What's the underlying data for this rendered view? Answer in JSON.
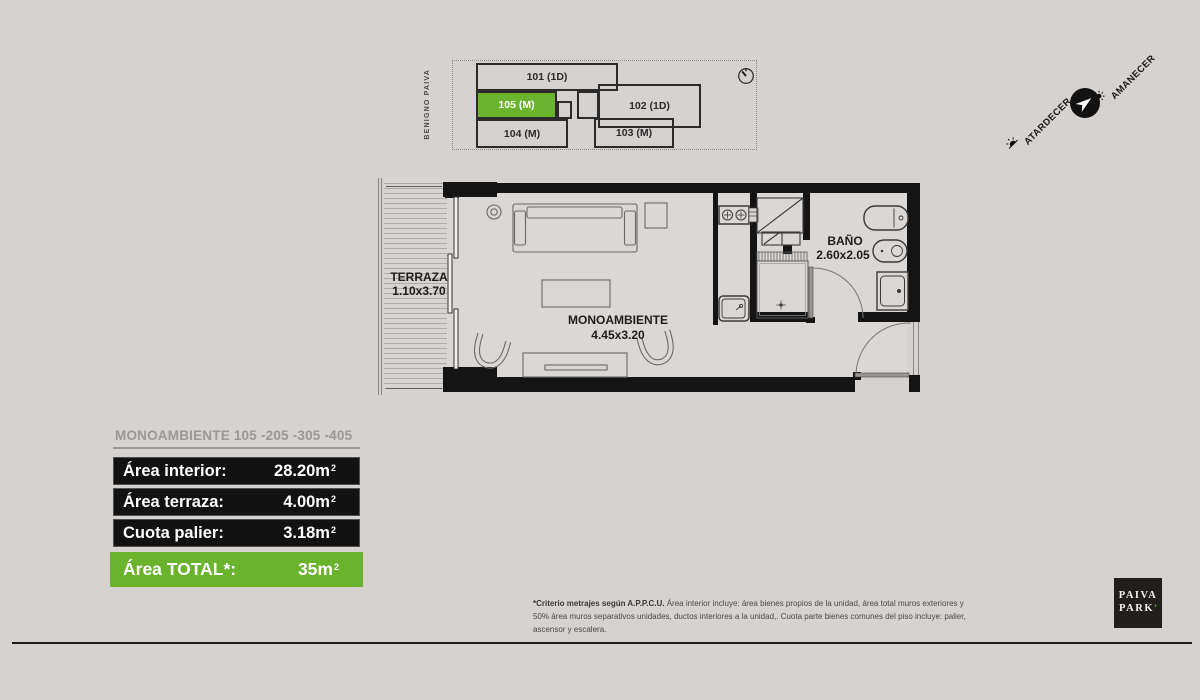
{
  "colors": {
    "green": "#6ab32d",
    "wall": "#141414",
    "background": "#d6d2d0"
  },
  "key_plan": {
    "street_label": "BENIGNO PAIVA",
    "units": [
      {
        "label": "101 (1D)"
      },
      {
        "label": "105 (M)"
      },
      {
        "label": "102 (1D)"
      },
      {
        "label": "103 (M)"
      },
      {
        "label": "104 (M)"
      }
    ]
  },
  "orientation": {
    "sunset_label": "ATARDECER",
    "sunrise_label": "AMANECER"
  },
  "floor_plan": {
    "rooms": [
      {
        "name": "TERRAZA",
        "dims": "1.10x3.70"
      },
      {
        "name": "MONOAMBIENTE",
        "dims": "4.45x3.20"
      },
      {
        "name": "BAÑO",
        "dims": "2.60x2.05"
      }
    ]
  },
  "summary": {
    "title": "MONOAMBIENTE 105 -205 -305 -405",
    "rows": [
      {
        "label": "Área interior:",
        "value": "28.20m",
        "sup": "2"
      },
      {
        "label": "Área terraza:",
        "value": "4.00m",
        "sup": "2"
      },
      {
        "label": "Cuota palier:",
        "value": "3.18m",
        "sup": "2"
      }
    ],
    "total": {
      "label": "Área TOTAL*:",
      "value": "35m",
      "sup": "2"
    }
  },
  "disclaimer": {
    "bold": "*Criterio metrajes según A.P.P.C.U.",
    "text": " Área interior incluye: área bienes propios de la unidad, área total muros exteriores y 50% área muros separativos unidades, ductos interiores a la unidad,. Cuota parte bienes comunes del piso incluye: palier, ascensor y escalera."
  },
  "logo": {
    "line1": "PAIVA",
    "line2": "PARK",
    "accent": "’"
  }
}
